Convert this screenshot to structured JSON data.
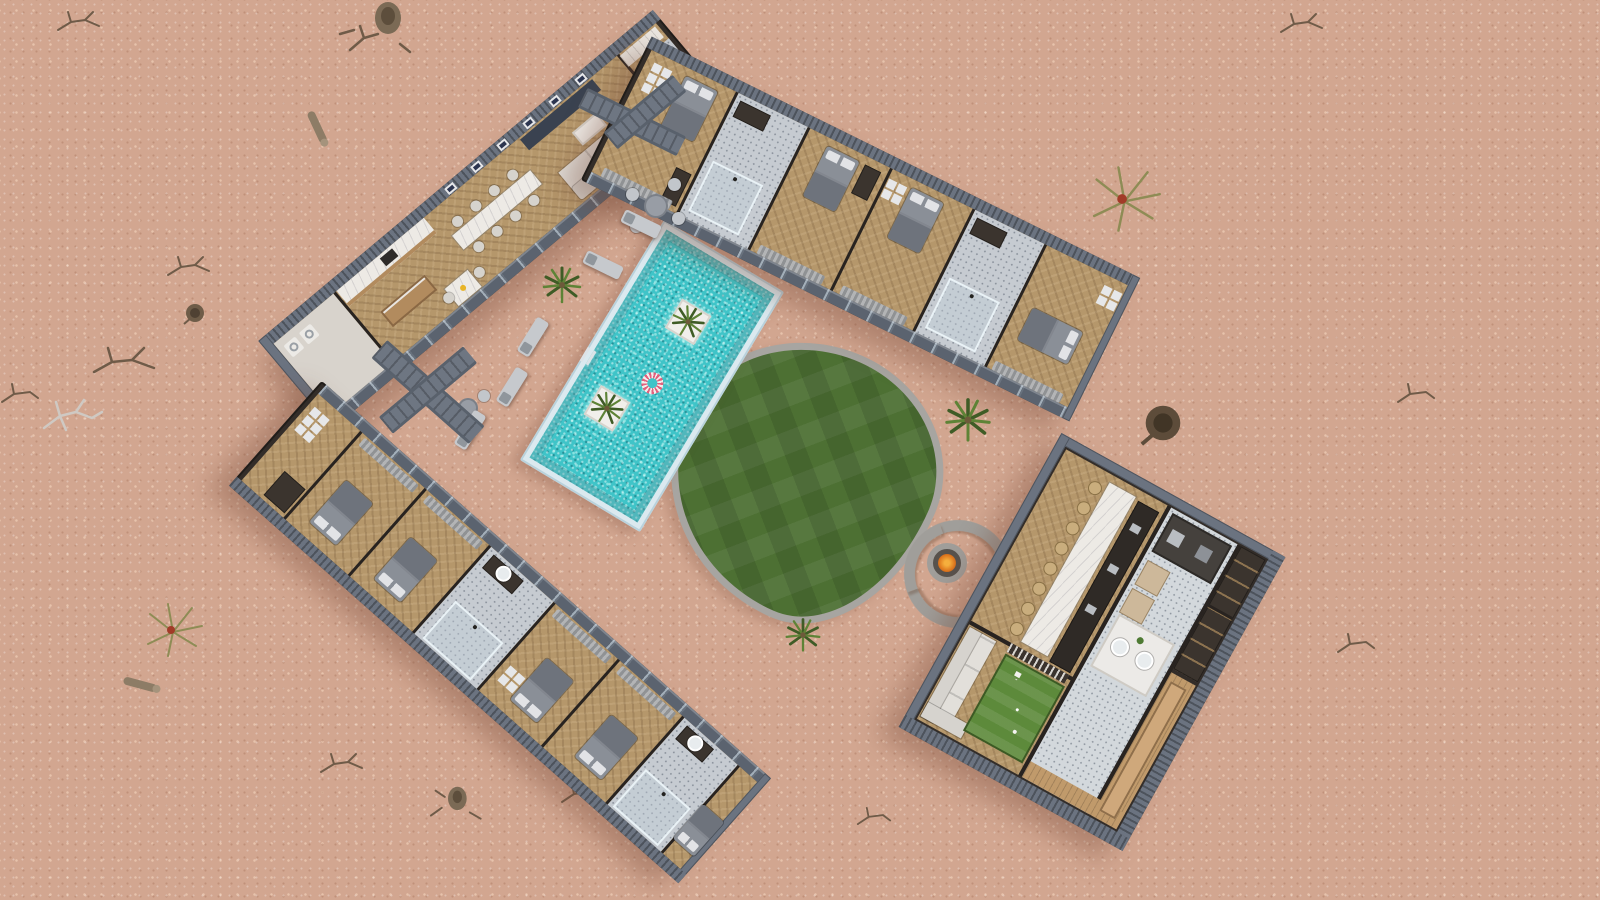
{
  "scene": {
    "title": "Aerial 3D render of a desert resort compound",
    "environment": "pink desert sand with scattered dead trees, logs and dry shrubs",
    "view": "top-down axonometric cutaway floor plan"
  },
  "palette": {
    "sand": "#d2a690",
    "sandLight": "#e7c3ac",
    "roofSlate": "#6b7380",
    "roofSlateDark": "#4f5660",
    "wallDark": "#332d29",
    "wallDarker": "#282320",
    "glass": "#5b636f",
    "floorWood": "#b5976b",
    "tile": "#c6cbd1",
    "marble": "#edeae5",
    "woodCabinet": "#b28b5e",
    "bed": "#8a8f97",
    "blanket": "#6e737c",
    "pillow": "#e2e3e6",
    "sofa": "#e2dfda",
    "sofaBack": "#d6d3ce",
    "frame": "#e6e7e9",
    "curtainA": "#b3b7bc",
    "curtainB": "#8d9298",
    "chairWhite": "#d6d3cd",
    "chairTan": "#c9ad7d",
    "barDark": "#2f2a26",
    "steel": "#b9bdc2",
    "prep": "#cdb89a",
    "deck": "#c09a6b",
    "counterWood": "#cfa87b",
    "stone": "#a09e9a",
    "pit": "#57524d",
    "fireOuter": "#a84514",
    "fireInner": "#f7b13e",
    "pool": "#3fc4c8",
    "poolEdge": "#dbe9ef",
    "lawn": "#4d7033",
    "lawnEdge": "#a7a5a1",
    "puttingGreen": "#5d8a3b",
    "ringPink": "#e2607d",
    "ringWhite": "#f2eeec",
    "washer": "#eceae6"
  },
  "compound": {
    "buildings": [
      {
        "id": "main-house",
        "label": "Main house",
        "spaces": [
          "laundry",
          "kitchen",
          "breakfast table",
          "dining table",
          "living room with TV wall",
          "wardrobe suite",
          "bathroom"
        ]
      },
      {
        "id": "north-guest-wing",
        "label": "North guest wing",
        "bedrooms": 4,
        "bathrooms": 2
      },
      {
        "id": "west-guest-wing",
        "label": "West guest wing",
        "bedrooms": 5,
        "bathrooms": 2,
        "storage_rooms": 1
      },
      {
        "id": "club-house",
        "label": "Club house",
        "spaces": [
          "dining hall with long marble table",
          "bar counter",
          "kitchen with island sinks",
          "storage rooms",
          "lounge sofa",
          "putting green",
          "wood deck with counter"
        ]
      }
    ],
    "courtyard": {
      "pool": {
        "planters_with_palms": 2,
        "swim_rings": 1,
        "ladders": 1
      },
      "lawn": {
        "shape": "organic blob",
        "pattern": "checker mowing"
      },
      "fire_pit": {
        "benches": 4
      },
      "sun_loungers": 5,
      "cafe_sets": [
        {
          "chairs": 4
        },
        {
          "chairs": 2
        }
      ],
      "plants": 3
    },
    "desert_items": {
      "dead_branches": 10,
      "stumps_and_logs": 6,
      "dry_shrubs": 2,
      "bare_trees": 1
    }
  }
}
